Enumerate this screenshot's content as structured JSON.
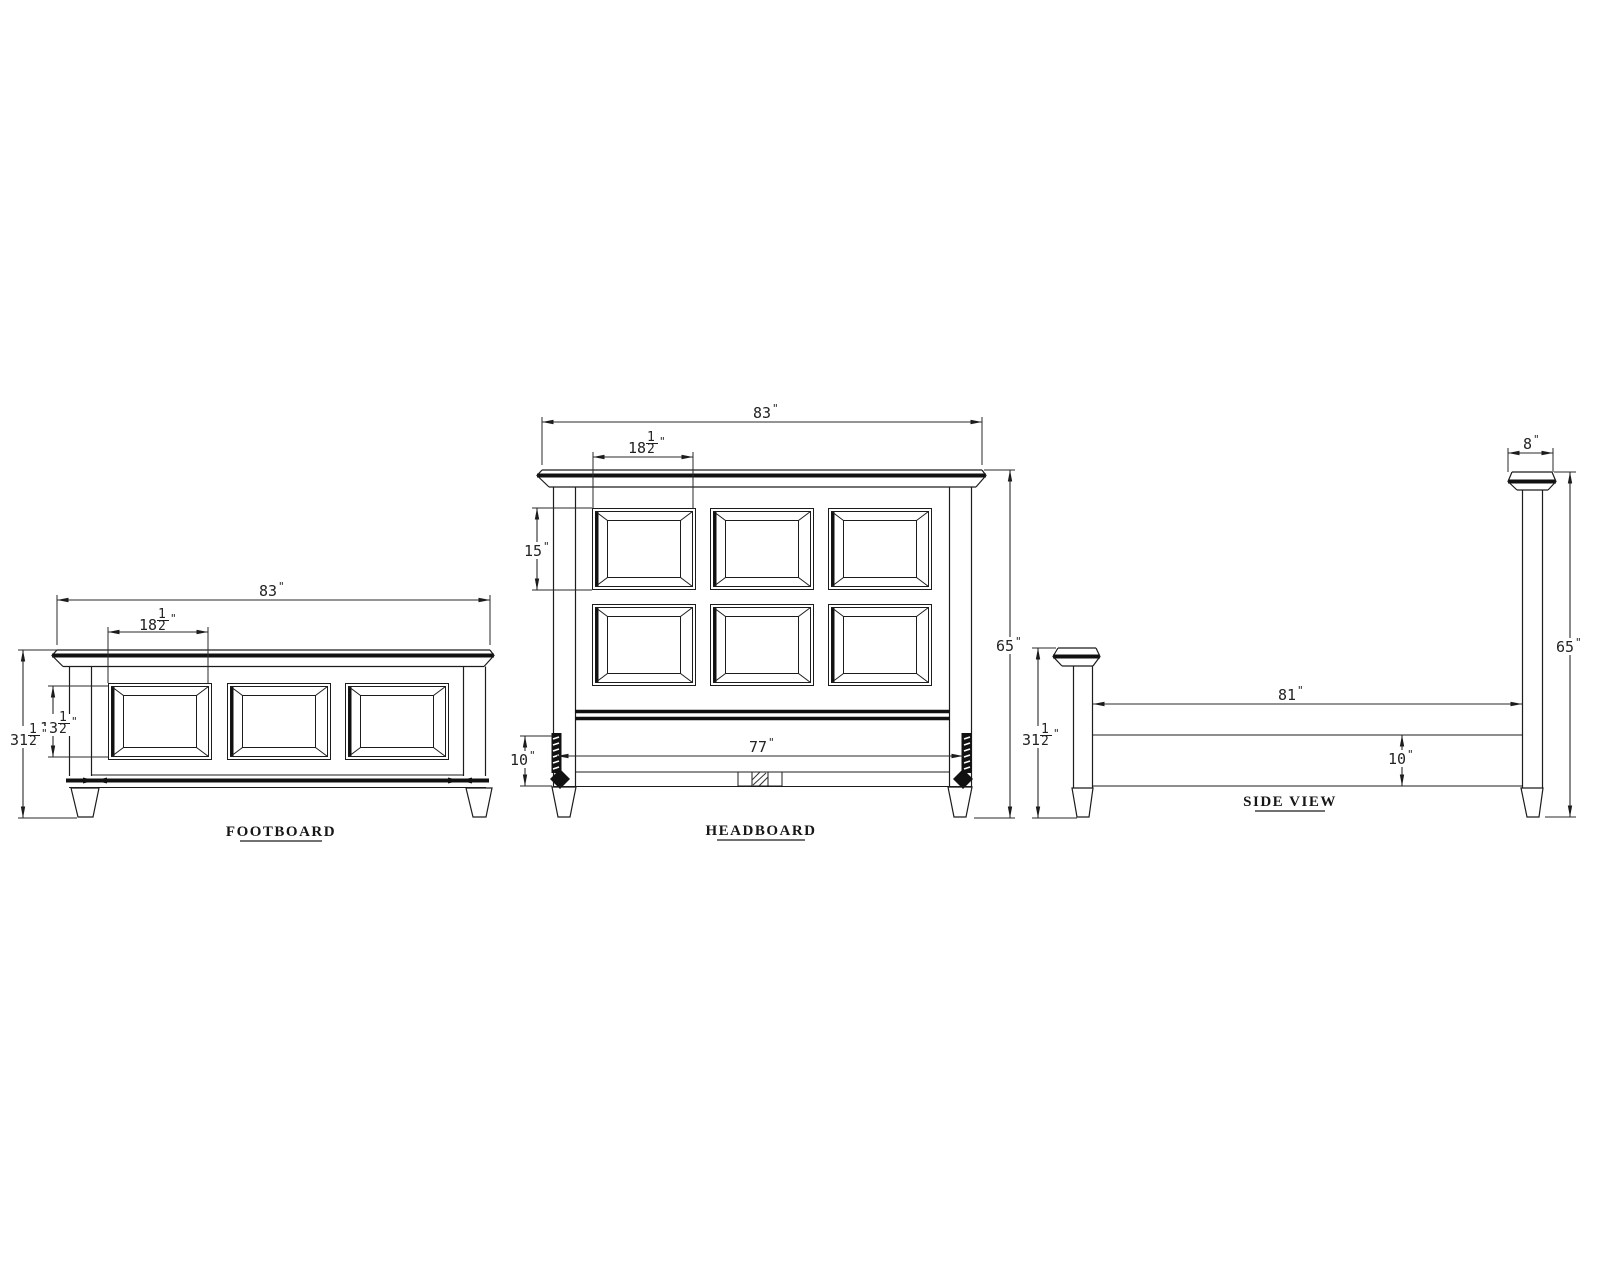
{
  "colors": {
    "background": "#ffffff",
    "line": "#1c1c1c"
  },
  "views": {
    "footboard": {
      "label": "FOOTBOARD",
      "dims": {
        "overall_width": {
          "whole": "83",
          "unit": "\""
        },
        "panel_width": {
          "whole": "18",
          "num": "1",
          "den": "2",
          "unit": "\""
        },
        "panel_height": {
          "whole": "13",
          "num": "1",
          "den": "2",
          "unit": "\""
        },
        "overall_height": {
          "whole": "31",
          "num": "1",
          "den": "2",
          "unit": "\""
        }
      }
    },
    "headboard": {
      "label": "HEADBOARD",
      "dims": {
        "overall_width": {
          "whole": "83",
          "unit": "\""
        },
        "panel_width": {
          "whole": "18",
          "num": "1",
          "den": "2",
          "unit": "\""
        },
        "panel_height": {
          "whole": "15",
          "unit": "\""
        },
        "inner_width": {
          "whole": "77",
          "unit": "\""
        },
        "bracket_height": {
          "whole": "10",
          "unit": "\""
        },
        "overall_height": {
          "whole": "65",
          "unit": "\""
        }
      }
    },
    "side": {
      "label": "SIDE VIEW",
      "dims": {
        "post_cap_width": {
          "whole": "8",
          "unit": "\""
        },
        "rail_length": {
          "whole": "81",
          "unit": "\""
        },
        "rail_height": {
          "whole": "10",
          "unit": "\""
        },
        "footboard_height": {
          "whole": "31",
          "num": "1",
          "den": "2",
          "unit": "\""
        },
        "post_height": {
          "whole": "65",
          "unit": "\""
        }
      }
    }
  }
}
